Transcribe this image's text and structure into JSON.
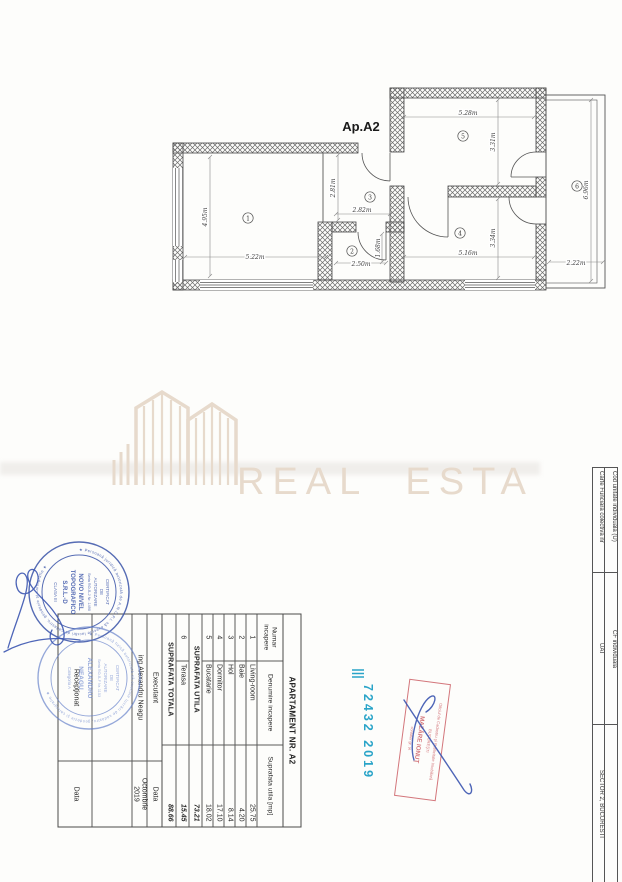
{
  "plan": {
    "label": "Ap.A2",
    "rooms": [
      {
        "num": "1",
        "w": "5.22m",
        "h": "4.95m"
      },
      {
        "num": "2",
        "w": "2.50m",
        "h": "1.68m"
      },
      {
        "num": "3",
        "w": "2.82m",
        "h": "2.81m"
      },
      {
        "num": "4",
        "w": "5.16m",
        "h": "3.34m"
      },
      {
        "num": "5",
        "w": "5.28m",
        "h": "3.31m"
      },
      {
        "num": "6",
        "w": "2.22m",
        "h": "6.96m"
      }
    ]
  },
  "watermark": {
    "text": "REAL ESTATE"
  },
  "table": {
    "title": "APARTAMENT NR. A2",
    "columns": [
      "Numar incapere",
      "Denumire incapere",
      "Suprafata utila [mp]"
    ],
    "rows": [
      [
        "1",
        "Living-room",
        "25.75"
      ],
      [
        "2",
        "Baie",
        "4.20"
      ],
      [
        "3",
        "Hol",
        "8.14"
      ],
      [
        "4",
        "Dormitor",
        "17.10"
      ],
      [
        "5",
        "Bucatarie",
        "18.02"
      ]
    ],
    "subtotal": {
      "label": "SUPRAFATA UTILA",
      "value": "73.21"
    },
    "terrace_row": [
      "6",
      "Terasa",
      "15.45"
    ],
    "total": {
      "label": "SUPRAFATA TOTALA",
      "value": "88.66"
    }
  },
  "signoff": {
    "executant_label": "Executant",
    "executant_name": "ing.Alexandru Neagu",
    "data_label": "Data",
    "date_value": "Octombrie 2019",
    "receptionat_label": "Recepţionat",
    "receptionat_data_label": "Data"
  },
  "stamps": {
    "stamp1": {
      "ring": "★ Persoană juridică autorizată de A.N.C.P.I. să execute lucrări de cadastru, geodezie şi cartografie ★",
      "l1": "CERTIFICAT",
      "l2": "DE",
      "l3": "AUTORIZARE",
      "l4": "Seria RO-B-J Nr. 1490",
      "l5": "NOVO NIVEL",
      "l6": "TOPOGRAFICO",
      "l7": "S.R.L.-D",
      "l8": "CLASA III",
      "color": "#3953a8"
    },
    "stamp2": {
      "ring": "★ Persoană fizică autorizată să execute lucrări de cadastru, geodezie şi cartografie ★",
      "l1": "CERTIFICAT",
      "l2": "DE",
      "l3": "AUTORIZARE",
      "l4": "Seria RO-B-F Nr. 1153",
      "l5": "ALEXANDRU",
      "l6": "NEAGU",
      "l7": "Categoria A",
      "color": "#5f7bc8"
    }
  },
  "registration": {
    "number": "72432 2019",
    "color": "#2aa4c8"
  },
  "red_stamp": {
    "l1": "Oficiul de Cadastru şi Publicitate Imobiliară",
    "l2": "BUCUREŞTI",
    "l3": "MAZĂRE IONUŢ",
    "l4": "consilier gr. IA",
    "color": "#c9555c"
  },
  "sidebar": {
    "cells_left": [
      "Carte Funciara colectiva nr",
      "UAT",
      "SECTOR 2, BUCURESTI"
    ],
    "cells_right": [
      "Cod unitate individuala (U)",
      "CF individuala",
      ""
    ]
  }
}
